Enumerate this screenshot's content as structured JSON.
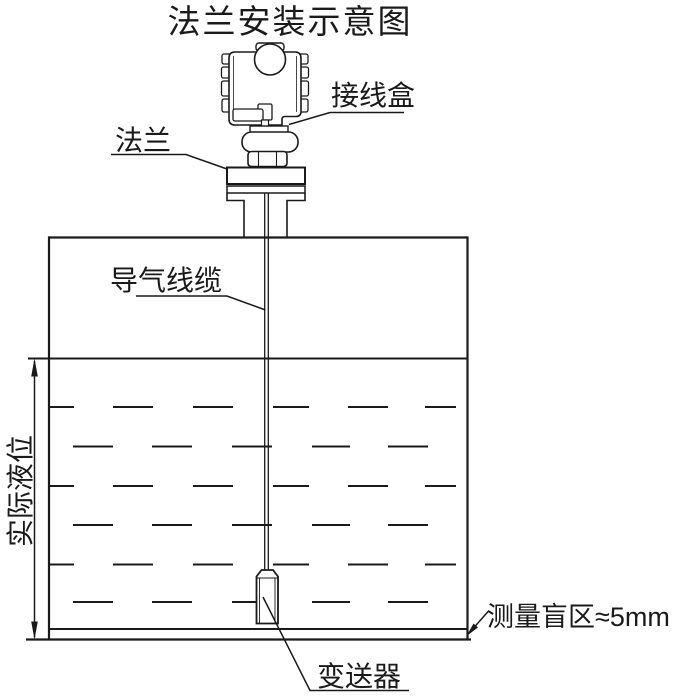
{
  "diagram": {
    "title": "法兰安装示意图",
    "labels": {
      "junction_box": "接线盒",
      "flange": "法兰",
      "air_cable": "导气线缆",
      "actual_level": "实际液位",
      "transmitter": "变送器",
      "blind_zone": "测量盲区≈5mm"
    },
    "colors": {
      "line": "#1a1a1a",
      "background": "#ffffff"
    }
  }
}
